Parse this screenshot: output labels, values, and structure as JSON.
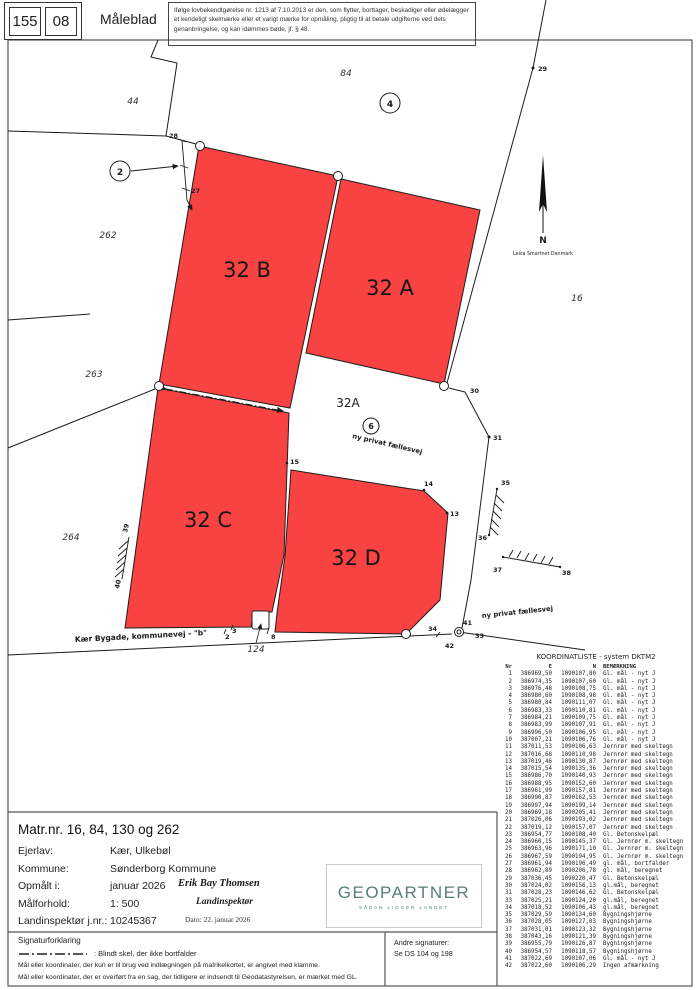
{
  "header": {
    "stamp_left": "155",
    "stamp_right": "08",
    "title": "Måleblad",
    "legal_notice": "Ifølge lovbekendtgørelse nr. 1213 af 7.10.2013 er den, som flytter, borttager, beskadiger eller ødelægger et kendeligt skelmærke eller et varigt mærke for opmåling, pligtig til at betale udgifterne ved dets genanbringelse, og kan idømmes bøde, jf. § 48."
  },
  "map": {
    "red_color": "#f94343",
    "labels": {
      "parcel_b": "32 B",
      "parcel_a": "32 A",
      "parcel_c": "32 C",
      "parcel_d": "32 D",
      "road_parcel": "32A",
      "faellesvej_mid": "ny privat fællesvej",
      "faellesvej_right": "ny privat fællesvej",
      "street": "Kær Bygade, kommunevej - \"b\"",
      "n44": "44",
      "n84": "84",
      "n262": "262",
      "n263": "263",
      "n264": "264",
      "n16": "16",
      "n124": "124",
      "c2": "2",
      "c4": "4",
      "c6": "6",
      "p2": "2",
      "p3": "3",
      "p8": "8",
      "p13": "13",
      "p14": "14",
      "p15": "15",
      "p27": "27",
      "p28": "28",
      "p29": "29",
      "p30": "30",
      "p31": "31",
      "p33": "33",
      "p34": "34",
      "p35": "35",
      "p36": "36",
      "p37": "37",
      "p38": "38",
      "p39": "39",
      "p40": "40",
      "p41": "41",
      "p42": "42",
      "north": "N",
      "north_src": "Leica Smartnet Danmark"
    }
  },
  "info": {
    "matr_line": "Matr.nr. 16, 84, 130 og 262",
    "rows": [
      {
        "label": "Ejerlav:",
        "value": "Kær, Ulkebøl"
      },
      {
        "label": "Kommune:",
        "value": "Sønderborg Kommune"
      },
      {
        "label": "Opmålt i:",
        "value": "januar 2026"
      },
      {
        "label": "Målforhold:",
        "value": "1: 500"
      },
      {
        "label": "Landinspektør j.nr.:",
        "value": "10245367"
      }
    ],
    "surveyor_name": "Erik Bay Thomsen",
    "surveyor_title": "Landinspektør",
    "date_line": "Dato: 22. januar 2026",
    "logo_text": "GEOPARTNER",
    "logo_tagline": "SÅDAN LIGGER LANDET"
  },
  "legend": {
    "title": "Signaturforklaring",
    "blind_skel": ":  Blindt skel, der ikke bortfalder",
    "line1": "Mål eller koordinater, der kun er til brug ved indlægningen på matrikelkortet, er angivet med klamme.",
    "line2": "Mål eller koordinater, der er overført fra en sag, der tidligere er indsendt til Geodatastyrelsen, er mærket med GL.",
    "other_title": "Andre signaturer:",
    "other_value": "Se DS 104 og 198"
  },
  "coordinate_list": {
    "title": "KOORDINATLISTE - system DKTM2",
    "columns": [
      "Nr",
      "E",
      "N",
      "BEMÆRKNING"
    ],
    "rows": [
      [
        "1",
        "386969,50",
        "1090107,80",
        "Gl. mål - nyt J"
      ],
      [
        "2",
        "386974,35",
        "1090107,60",
        "Gl. mål - nyt J"
      ],
      [
        "3",
        "386976,48",
        "1090108,75",
        "Gl. mål - nyt J"
      ],
      [
        "4",
        "386980,60",
        "1090108,98",
        "Gl. mål - nyt J"
      ],
      [
        "5",
        "386980,84",
        "1090111,07",
        "Gl. mål - nyt J"
      ],
      [
        "6",
        "386983,33",
        "1090110,81",
        "Gl. mål - nyt J"
      ],
      [
        "7",
        "386984,21",
        "1090109,75",
        "Gl. mål - nyt J"
      ],
      [
        "8",
        "386983,99",
        "1090107,91",
        "Gl. mål - nyt J"
      ],
      [
        "9",
        "386996,50",
        "1090106,95",
        "Gl. mål - nyt J"
      ],
      [
        "10",
        "387007,21",
        "1090106,76",
        "Gl. mål - nyt J"
      ],
      [
        "11",
        "387011,53",
        "1090106,63",
        "Jernrør med skeltegn"
      ],
      [
        "12",
        "387016,68",
        "1090110,98",
        "Jernrør med skeltegn"
      ],
      [
        "13",
        "387019,46",
        "1090130,87",
        "Jernrør med skeltegn"
      ],
      [
        "14",
        "387015,54",
        "1090135,36",
        "Jernrør med skeltegn"
      ],
      [
        "15",
        "386986,70",
        "1090140,93",
        "Jernrør med skeltegn"
      ],
      [
        "16",
        "386988,95",
        "1090152,60",
        "Jernrør med skeltegn"
      ],
      [
        "17",
        "386961,99",
        "1090157,81",
        "Jernrør med skeltegn"
      ],
      [
        "18",
        "386990,87",
        "1090162,53",
        "Jernrør med skeltegn"
      ],
      [
        "19",
        "386997,94",
        "1090199,14",
        "Jernrør med skeltegn"
      ],
      [
        "20",
        "386969,18",
        "1090205,41",
        "Jernrør med skeltegn"
      ],
      [
        "21",
        "387026,06",
        "1090193,02",
        "Jernrør med skeltegn"
      ],
      [
        "22",
        "387019,12",
        "1090157,07",
        "Jernrør med skeltegn"
      ],
      [
        "23",
        "386954,77",
        "1090108,40",
        "Gl. Betonskelpæl"
      ],
      [
        "24",
        "386960,15",
        "1090145,37",
        "Gl. Jernrør m. skeltegn"
      ],
      [
        "25",
        "386963,96",
        "1090171,10",
        "Gl. Jernrør m. skeltegn"
      ],
      [
        "26",
        "386967,59",
        "1090194,95",
        "Gl. Jernrør m. skeltegn"
      ],
      [
        "27",
        "386961,94",
        "1090196,49",
        "gl. mål, bortfalder"
      ],
      [
        "28",
        "386962,89",
        "1090206,78",
        "gl. mål, beregnet"
      ],
      [
        "29",
        "387036,45",
        "1090220,47",
        "Gl. Betonskelpæl"
      ],
      [
        "30",
        "387024,02",
        "1090156,13",
        "gl.mål, beregnet"
      ],
      [
        "31",
        "387028,23",
        "1090146,62",
        "Gl. Betonskelpæl"
      ],
      [
        "33",
        "387025,21",
        "1090124,20",
        "gl.mål, beregnet"
      ],
      [
        "34",
        "387018,52",
        "1090106,43",
        "gl.mål, beregnet"
      ],
      [
        "35",
        "387029,59",
        "1090134,60",
        "Bygningshjørne"
      ],
      [
        "36",
        "387028,05",
        "1090127,03",
        "Bygningshjørne"
      ],
      [
        "37",
        "387031,01",
        "1090123,32",
        "Bygningshjørne"
      ],
      [
        "38",
        "387043,16",
        "1090121,39",
        "Bygningshjørne"
      ],
      [
        "39",
        "386955,79",
        "1090126,87",
        "Bygningshjørne"
      ],
      [
        "40",
        "386954,57",
        "1090118,57",
        "Bygningshjørne"
      ],
      [
        "41",
        "387022,69",
        "1090107,06",
        "Gl. mål - nyt J"
      ],
      [
        "42",
        "387022,60",
        "1090106,29",
        "Ingen afmærkning"
      ]
    ]
  }
}
